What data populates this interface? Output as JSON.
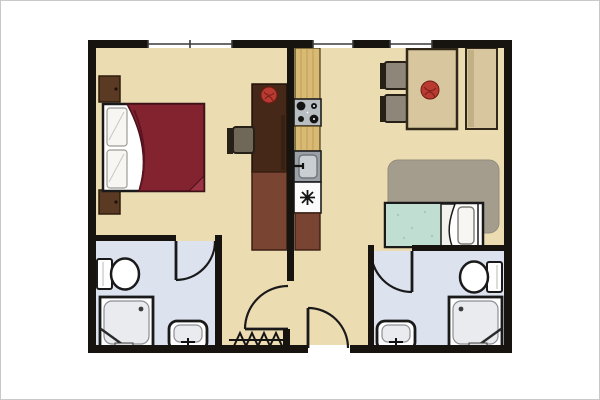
{
  "image": {
    "kind": "apartment-floor-plan",
    "width_px": 600,
    "height_px": 400,
    "visible_text": ""
  },
  "colors": {
    "background": "#ffffff",
    "frame_border": "#c9c9c9",
    "wall": "#17140f",
    "floor": "#ecdcb2",
    "bath_floor": "#dde2ef",
    "window_fill": "#ffffff",
    "window_line": "#3a3a3a",
    "door": "#1a1a1a",
    "bed_blanket": "#82232f",
    "bed_blanket_fold": "#5c1420",
    "bed_corner_fold": "#9b3442",
    "pillow": "#f7f6f3",
    "pillow_line": "#9d9b94",
    "nightstand": "#5a3a22",
    "nightstand_edge": "#2e1c0e",
    "desk_upper": "#452817",
    "desk_lower": "#7a4433",
    "chair_seat": "#6f6758",
    "dining_chair_seat": "#8d8679",
    "chair_frame": "#262016",
    "counter_wood": "#d9ba74",
    "counter_grain": "#bf9f55",
    "stove_body": "#b9bec2",
    "burner": "#141414",
    "sink_surround": "#9aa0a6",
    "sink_basin": "#c9ced3",
    "appliance": "#fbfbfb",
    "symbol": "#141414",
    "dining_wood": "#d8c79e",
    "wood_edge": "#32281a",
    "wood_shadow": "#c3b186",
    "plant": "#b93a31",
    "plant_detail": "#7e211b",
    "rug": "#a49c8c",
    "rug_edge": "#948c7c",
    "teal_blanket": "#c0ded2",
    "teal_speckle": "#a6cabb",
    "fixture": "#ffffff",
    "fixture_outline": "#1a1a1a",
    "fixture_inner": "#e9ebee",
    "fixture_inner_line": "#8a8f94"
  },
  "rooms": [
    {
      "id": "bedroom-living-left"
    },
    {
      "id": "kitchen-center"
    },
    {
      "id": "dining-top-right"
    },
    {
      "id": "bedroom-right"
    },
    {
      "id": "bathroom-left"
    },
    {
      "id": "bathroom-right"
    },
    {
      "id": "entry-hall"
    }
  ],
  "symbols": [
    "double-bed",
    "single-bed",
    "nightstand",
    "desk",
    "desk-chair",
    "dining-table",
    "dining-chair",
    "sideboard",
    "kitchen-counter",
    "stove-4-burners",
    "kitchen-sink",
    "appliance-asterisk",
    "toilet",
    "shower",
    "washbasin",
    "rug",
    "plant",
    "radiator-zigzag",
    "door-swing",
    "window"
  ]
}
